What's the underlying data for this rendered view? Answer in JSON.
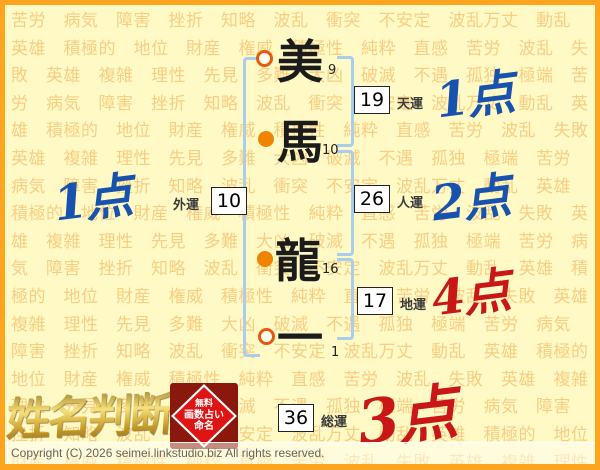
{
  "page": {
    "background_words_cycle": [
      "苦労",
      "病気",
      "障害",
      "挫折",
      "知略",
      "波乱",
      "衝突",
      "不安定",
      "波乱万丈",
      "動乱",
      "英雄",
      "積極的",
      "地位",
      "財産",
      "権威",
      "積極性",
      "純粋",
      "直感",
      "苦労",
      "波乱",
      "失敗",
      "英雄",
      "複雑",
      "理性",
      "先見",
      "多難",
      "大凶",
      "破滅",
      "不遇",
      "孤独",
      "極端"
    ],
    "background_repeat": 7
  },
  "name": {
    "characters": [
      {
        "char": "美",
        "strokes": "9",
        "marker": "hollow"
      },
      {
        "char": "馬",
        "strokes": "10",
        "marker": "filled"
      },
      {
        "char": "龍",
        "strokes": "16",
        "marker": "filled"
      },
      {
        "char": "一",
        "strokes": "1",
        "marker": "hollow"
      }
    ]
  },
  "fortunes": {
    "tenun": {
      "value": "19",
      "label": "天運",
      "score": "1点",
      "score_color": "blue"
    },
    "jinun": {
      "value": "26",
      "label": "人運",
      "score": "2点",
      "score_color": "blue"
    },
    "chiun": {
      "value": "17",
      "label": "地運",
      "score": "4点",
      "score_color": "red"
    },
    "gaiun": {
      "value": "10",
      "label": "外運",
      "score": "1点",
      "score_color": "blue"
    },
    "souun": {
      "value": "36",
      "label": "総運",
      "score": "3点",
      "score_color": "red"
    }
  },
  "branding": {
    "logo_text": "姓名判断",
    "stamp_lines": [
      "無料",
      "画数占い",
      "命名"
    ]
  },
  "footer": {
    "copyright": "Copyright (C) 2026 seimei.linkstudio.biz All rights reserved."
  },
  "colors": {
    "accent_border": "#FFA41F",
    "background": "#FFF9C5",
    "background_word": "#F3AC4D",
    "bracket_blue": "#A9CDEE",
    "score_blue": "#1652AE",
    "score_red": "#C91616",
    "marker_orange": "#F08300",
    "marker_ring": "#E7590E",
    "stamp_red": "#DF1414",
    "stamp_dark": "#8A180C"
  }
}
